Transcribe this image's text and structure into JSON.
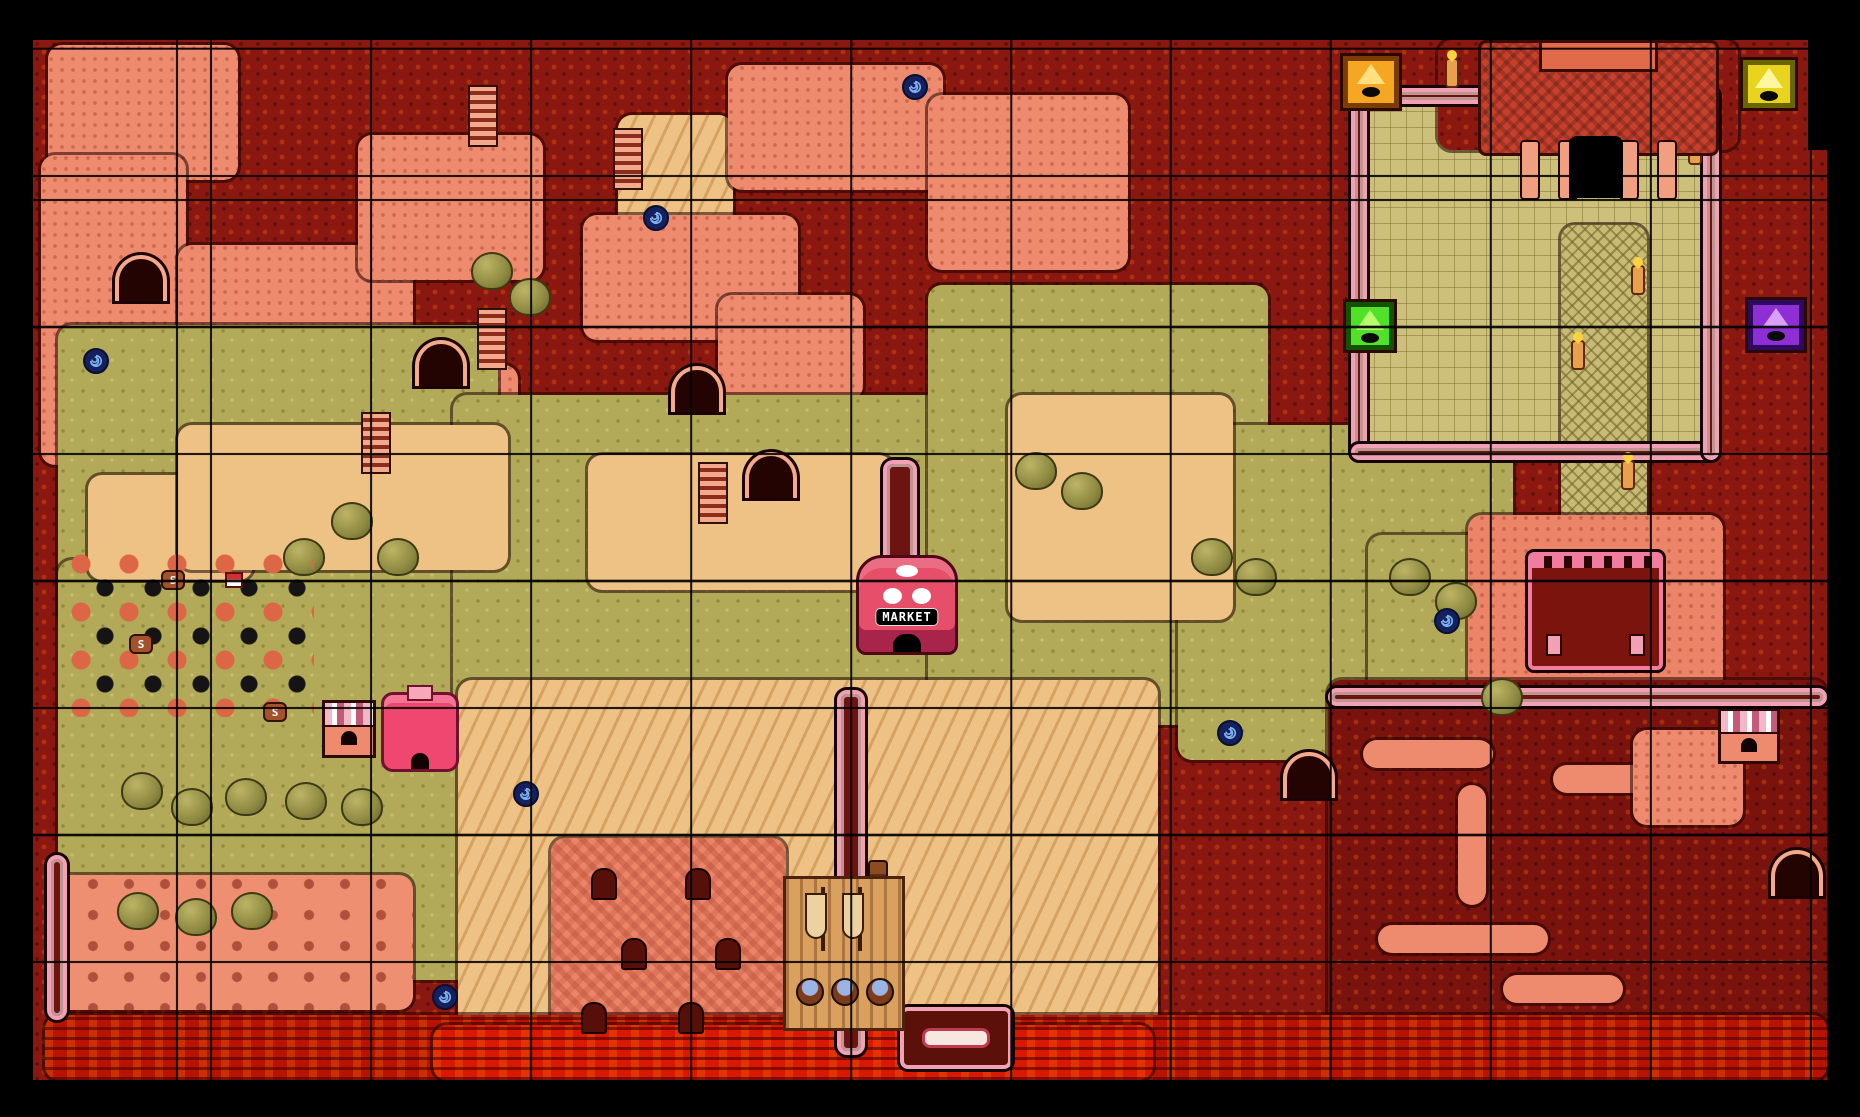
{
  "screen": {
    "frame_color": "#000000",
    "map_offset": {
      "x": 33,
      "y": 40
    },
    "map_size": {
      "w": 1794,
      "h": 1040
    }
  },
  "grid": {
    "cell_w": 160,
    "cell_h": 127,
    "offset_x": 177,
    "offset_y": 137,
    "line_color": "#000000"
  },
  "palette": {
    "rock_dark_red": "#8a1810",
    "maze_maroon": "#7a130d",
    "salmon": "#ee8a6e",
    "beach_salmon": "#ef8f72",
    "olive": "#b2aa58",
    "tan": "#eec185",
    "khaki": "#ccc07a",
    "lava_dark": "#b81300",
    "lava_bright": "#d81800",
    "wall_pink": "#f2a0b4",
    "market_pink": "#e64e6a",
    "portal_navy": "#16205e",
    "portal_spiral": "#7db2f0"
  },
  "map": {
    "regions": [
      {
        "n": "base-rock",
        "x": 0,
        "y": 0,
        "w": 1794,
        "h": 1040,
        "c": "#8a1810",
        "tex": "rock",
        "base": true
      },
      {
        "n": "ruins-salmon-1",
        "x": 15,
        "y": 5,
        "w": 190,
        "h": 135,
        "c": "#ee8a6e",
        "tex": "dots"
      },
      {
        "n": "ruins-salmon-2",
        "x": 8,
        "y": 115,
        "w": 145,
        "h": 310,
        "c": "#ee8a6e",
        "tex": "dots"
      },
      {
        "n": "ruins-salmon-3",
        "x": 145,
        "y": 205,
        "w": 235,
        "h": 125,
        "c": "#ee8a6e",
        "tex": "dots"
      },
      {
        "n": "ruins-salmon-4",
        "x": 325,
        "y": 95,
        "w": 185,
        "h": 145,
        "c": "#ee8a6e",
        "tex": "dots"
      },
      {
        "n": "tan-top",
        "x": 585,
        "y": 75,
        "w": 115,
        "h": 120,
        "c": "#eec185",
        "tex": "dunes"
      },
      {
        "n": "ruins-salmon-5",
        "x": 550,
        "y": 175,
        "w": 215,
        "h": 125,
        "c": "#ee8a6e",
        "tex": "dots"
      },
      {
        "n": "ruins-salmon-6",
        "x": 695,
        "y": 25,
        "w": 215,
        "h": 125,
        "c": "#ee8a6e",
        "tex": "dots"
      },
      {
        "n": "ruins-salmon-7",
        "x": 895,
        "y": 55,
        "w": 200,
        "h": 175,
        "c": "#ee8a6e",
        "tex": "dots"
      },
      {
        "n": "ruins-salmon-8",
        "x": 320,
        "y": 325,
        "w": 165,
        "h": 115,
        "c": "#ee8a6e",
        "tex": "dots"
      },
      {
        "n": "ruins-salmon-9",
        "x": 685,
        "y": 255,
        "w": 145,
        "h": 105,
        "c": "#ee8a6e",
        "tex": "dots"
      },
      {
        "n": "olive-left",
        "x": 25,
        "y": 285,
        "w": 440,
        "h": 300,
        "c": "#b2aa58",
        "tex": "grass"
      },
      {
        "n": "olive-bottom-left",
        "x": 25,
        "y": 520,
        "w": 420,
        "h": 420,
        "c": "#b2aa58",
        "tex": "grass"
      },
      {
        "n": "olive-center",
        "x": 420,
        "y": 355,
        "w": 630,
        "h": 335,
        "c": "#b2aa58",
        "tex": "grass"
      },
      {
        "n": "olive-right-center",
        "x": 895,
        "y": 245,
        "w": 340,
        "h": 440,
        "c": "#b2aa58",
        "tex": "grass"
      },
      {
        "n": "olive-right",
        "x": 1145,
        "y": 385,
        "w": 335,
        "h": 335,
        "c": "#b2aa58",
        "tex": "grass"
      },
      {
        "n": "olive-far-right",
        "x": 1335,
        "y": 495,
        "w": 340,
        "h": 235,
        "c": "#b2aa58",
        "tex": "grass"
      },
      {
        "n": "tan-left",
        "x": 55,
        "y": 435,
        "w": 165,
        "h": 105,
        "c": "#eec185",
        "tex": "plain"
      },
      {
        "n": "tan-mid-1",
        "x": 145,
        "y": 385,
        "w": 330,
        "h": 145,
        "c": "#eec185",
        "tex": "plain"
      },
      {
        "n": "tan-mid-2",
        "x": 555,
        "y": 415,
        "w": 305,
        "h": 135,
        "c": "#eec185",
        "tex": "plain"
      },
      {
        "n": "tan-right",
        "x": 975,
        "y": 355,
        "w": 225,
        "h": 225,
        "c": "#eec185",
        "tex": "plain"
      },
      {
        "n": "sand-dunes-bottom",
        "x": 425,
        "y": 640,
        "w": 700,
        "h": 370,
        "c": "#eec185",
        "tex": "dunes"
      },
      {
        "n": "beach-left",
        "x": 15,
        "y": 835,
        "w": 365,
        "h": 135,
        "c": "#ef8f72",
        "tex": "rocks"
      },
      {
        "n": "tan-corner-br",
        "x": 1675,
        "y": 795,
        "w": 119,
        "h": 205,
        "c": "#eec185",
        "tex": "dunes"
      },
      {
        "n": "garden-khaki",
        "x": 1325,
        "y": 55,
        "w": 355,
        "h": 365,
        "c": "#ccc07a",
        "tex": "tiles"
      },
      {
        "n": "temple-grounds",
        "x": 1405,
        "y": 0,
        "w": 300,
        "h": 110,
        "c": "#8a1810",
        "tex": "rock"
      },
      {
        "n": "khaki-path",
        "x": 1528,
        "y": 185,
        "w": 86,
        "h": 440,
        "c": "#c6ba74",
        "tex": "hatch"
      },
      {
        "n": "plaza-right",
        "x": 1435,
        "y": 475,
        "w": 255,
        "h": 225,
        "c": "#ec8468",
        "tex": "dots"
      },
      {
        "n": "graveyard",
        "x": 518,
        "y": 798,
        "w": 235,
        "h": 212,
        "c": "#ec8468",
        "tex": "checker"
      },
      {
        "n": "maze-bottom-right",
        "x": 1295,
        "y": 640,
        "w": 499,
        "h": 370,
        "c": "#7a130d",
        "tex": "rock"
      },
      {
        "n": "maze-path-1",
        "x": 1330,
        "y": 700,
        "w": 130,
        "h": 28,
        "c": "#ee8a6e",
        "tex": "plain"
      },
      {
        "n": "maze-path-2",
        "x": 1425,
        "y": 745,
        "w": 28,
        "h": 120,
        "c": "#ee8a6e",
        "tex": "plain"
      },
      {
        "n": "maze-path-3",
        "x": 1520,
        "y": 725,
        "w": 150,
        "h": 28,
        "c": "#ee8a6e",
        "tex": "plain"
      },
      {
        "n": "maze-path-4",
        "x": 1345,
        "y": 885,
        "w": 170,
        "h": 28,
        "c": "#ee8a6e",
        "tex": "plain"
      },
      {
        "n": "maze-path-5",
        "x": 1600,
        "y": 690,
        "w": 110,
        "h": 95,
        "c": "#ee8a6e",
        "tex": "dots"
      },
      {
        "n": "maze-path-6",
        "x": 1470,
        "y": 935,
        "w": 120,
        "h": 28,
        "c": "#ee8a6e",
        "tex": "plain"
      },
      {
        "n": "lava-strip",
        "x": 12,
        "y": 975,
        "w": 1782,
        "h": 65,
        "c": "#b81300",
        "tex": "lava"
      },
      {
        "n": "lava-bright",
        "x": 400,
        "y": 985,
        "w": 720,
        "h": 55,
        "c": "#d81800",
        "tex": "lava"
      }
    ],
    "market": {
      "label": "MARKET",
      "x": 823,
      "y": 515,
      "w": 102,
      "h": 100
    },
    "dungeon_markers": [
      {
        "name": "dungeon-marker-orange",
        "x": 1310,
        "y": 16,
        "w": 56,
        "h": 52,
        "fill": "#f5a623",
        "frame": "#7a3c00",
        "tri": "#ffe080"
      },
      {
        "name": "dungeon-marker-yellow",
        "x": 1710,
        "y": 20,
        "w": 52,
        "h": 48,
        "fill": "#e8d41c",
        "frame": "#6b6400",
        "tri": "#fff7a0"
      },
      {
        "name": "dungeon-marker-green",
        "x": 1313,
        "y": 262,
        "w": 48,
        "h": 48,
        "fill": "#52e029",
        "frame": "#145200",
        "tri": "#b8ff70"
      },
      {
        "name": "dungeon-marker-purple",
        "x": 1715,
        "y": 260,
        "w": 56,
        "h": 50,
        "fill": "#8e2fd6",
        "frame": "#2e0a5e",
        "tri": "#d9a0ff"
      }
    ],
    "portals": [
      {
        "x": 869,
        "y": 34
      },
      {
        "x": 610,
        "y": 165
      },
      {
        "x": 50,
        "y": 308
      },
      {
        "x": 480,
        "y": 741
      },
      {
        "x": 1184,
        "y": 680
      },
      {
        "x": 1401,
        "y": 568
      },
      {
        "x": 399,
        "y": 944
      }
    ],
    "walls": [
      {
        "x": 1318,
        "y": 48,
        "w": 368,
        "h": 16
      },
      {
        "x": 1318,
        "y": 48,
        "w": 16,
        "h": 372
      },
      {
        "x": 1318,
        "y": 404,
        "w": 368,
        "h": 16
      },
      {
        "x": 1670,
        "y": 48,
        "w": 16,
        "h": 372
      },
      {
        "x": 804,
        "y": 650,
        "w": 28,
        "h": 365
      },
      {
        "x": 14,
        "y": 815,
        "w": 20,
        "h": 165
      },
      {
        "x": 1295,
        "y": 648,
        "w": 499,
        "h": 18
      },
      {
        "x": 850,
        "y": 420,
        "w": 34,
        "h": 190
      }
    ],
    "caves": [
      {
        "x": 712,
        "y": 412
      },
      {
        "x": 382,
        "y": 300
      },
      {
        "x": 638,
        "y": 326
      },
      {
        "x": 82,
        "y": 215
      },
      {
        "x": 1250,
        "y": 712
      },
      {
        "x": 1738,
        "y": 810
      }
    ],
    "stairs": [
      {
        "x": 435,
        "y": 45
      },
      {
        "x": 580,
        "y": 88
      },
      {
        "x": 328,
        "y": 372
      },
      {
        "x": 444,
        "y": 268
      },
      {
        "x": 665,
        "y": 422
      }
    ],
    "trees": [
      {
        "x": 250,
        "y": 498
      },
      {
        "x": 298,
        "y": 462
      },
      {
        "x": 344,
        "y": 498
      },
      {
        "x": 88,
        "y": 732
      },
      {
        "x": 138,
        "y": 748
      },
      {
        "x": 192,
        "y": 738
      },
      {
        "x": 84,
        "y": 852
      },
      {
        "x": 142,
        "y": 858
      },
      {
        "x": 198,
        "y": 852
      },
      {
        "x": 252,
        "y": 742
      },
      {
        "x": 308,
        "y": 748
      },
      {
        "x": 1356,
        "y": 518
      },
      {
        "x": 1402,
        "y": 542
      },
      {
        "x": 1158,
        "y": 498
      },
      {
        "x": 1202,
        "y": 518
      },
      {
        "x": 982,
        "y": 412
      },
      {
        "x": 1028,
        "y": 432
      },
      {
        "x": 438,
        "y": 212
      },
      {
        "x": 476,
        "y": 238
      },
      {
        "x": 1448,
        "y": 638
      }
    ],
    "torches": [
      {
        "x": 1412,
        "y": 18
      },
      {
        "x": 1448,
        "y": 78
      },
      {
        "x": 1598,
        "y": 225
      },
      {
        "x": 1538,
        "y": 300
      },
      {
        "x": 1655,
        "y": 95
      },
      {
        "x": 1588,
        "y": 420
      }
    ],
    "tombstones": [
      {
        "x": 558,
        "y": 828
      },
      {
        "x": 652,
        "y": 828
      },
      {
        "x": 588,
        "y": 898
      },
      {
        "x": 682,
        "y": 898
      },
      {
        "x": 548,
        "y": 962
      },
      {
        "x": 645,
        "y": 962
      }
    ],
    "barrels": [
      {
        "x": 128,
        "y": 530,
        "label": "S"
      },
      {
        "x": 96,
        "y": 594,
        "label": "S"
      },
      {
        "x": 230,
        "y": 662,
        "label": "S"
      }
    ],
    "shops": [
      {
        "style": "striped",
        "x": 289,
        "y": 660,
        "w": 54,
        "h": 58
      },
      {
        "style": "pink",
        "x": 348,
        "y": 652,
        "w": 78,
        "h": 80
      },
      {
        "style": "striped",
        "x": 1685,
        "y": 668,
        "w": 62,
        "h": 56
      }
    ],
    "bush_patch": {
      "x": 36,
      "y": 512,
      "w": 245,
      "h": 165
    },
    "tiny_house": {
      "x": 192,
      "y": 532,
      "w": 18,
      "h": 16
    },
    "posts": {
      "x": 835,
      "y": 820,
      "w": 20,
      "h": 160
    },
    "platform": {
      "x": 867,
      "y": 967,
      "w": 112,
      "h": 62
    },
    "temple": {
      "x": 1445,
      "y": 0,
      "w": 235,
      "h": 190
    },
    "palace": {
      "x": 1495,
      "y": 512,
      "w": 135,
      "h": 118
    },
    "ship": {
      "x": 750,
      "y": 836,
      "w": 122,
      "h": 155
    }
  }
}
